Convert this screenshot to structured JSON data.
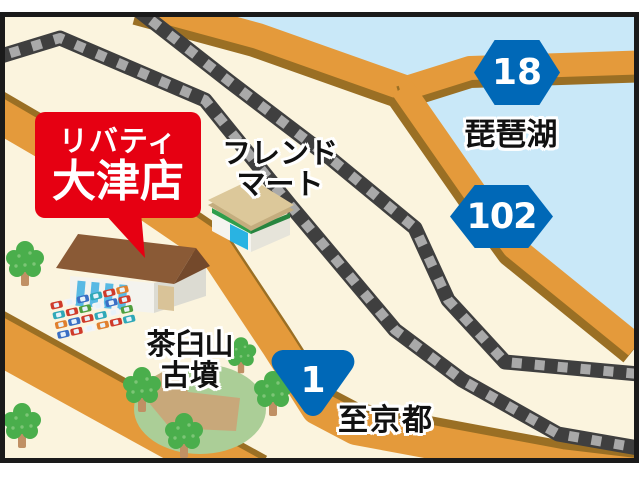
{
  "callout": {
    "line1": "リバティ",
    "line2": "大津店",
    "bg_color": "#e60012",
    "text_color": "#ffffff"
  },
  "labels": {
    "lake": "琵琶湖",
    "friend_mart_line1": "フレンド",
    "friend_mart_line2": "マート",
    "kofun_line1": "茶臼山",
    "kofun_line2": "古墳",
    "to_kyoto": "至京都"
  },
  "badges": {
    "route18": "18",
    "route102": "102",
    "route1": "1",
    "badge_color": "#0068b7"
  },
  "map_colors": {
    "land": "#fbf4de",
    "water": "#c9e8f8",
    "road_fill": "#e49a3b",
    "road_shadow": "#9a6f24",
    "rail_dark": "#3f3f3f",
    "rail_tick": "#a9a9a9",
    "park_green": "#abce97",
    "mound_path": "#c8a87a",
    "tree_green": "#4aae4c",
    "frame_border": "#1a1a1a"
  }
}
